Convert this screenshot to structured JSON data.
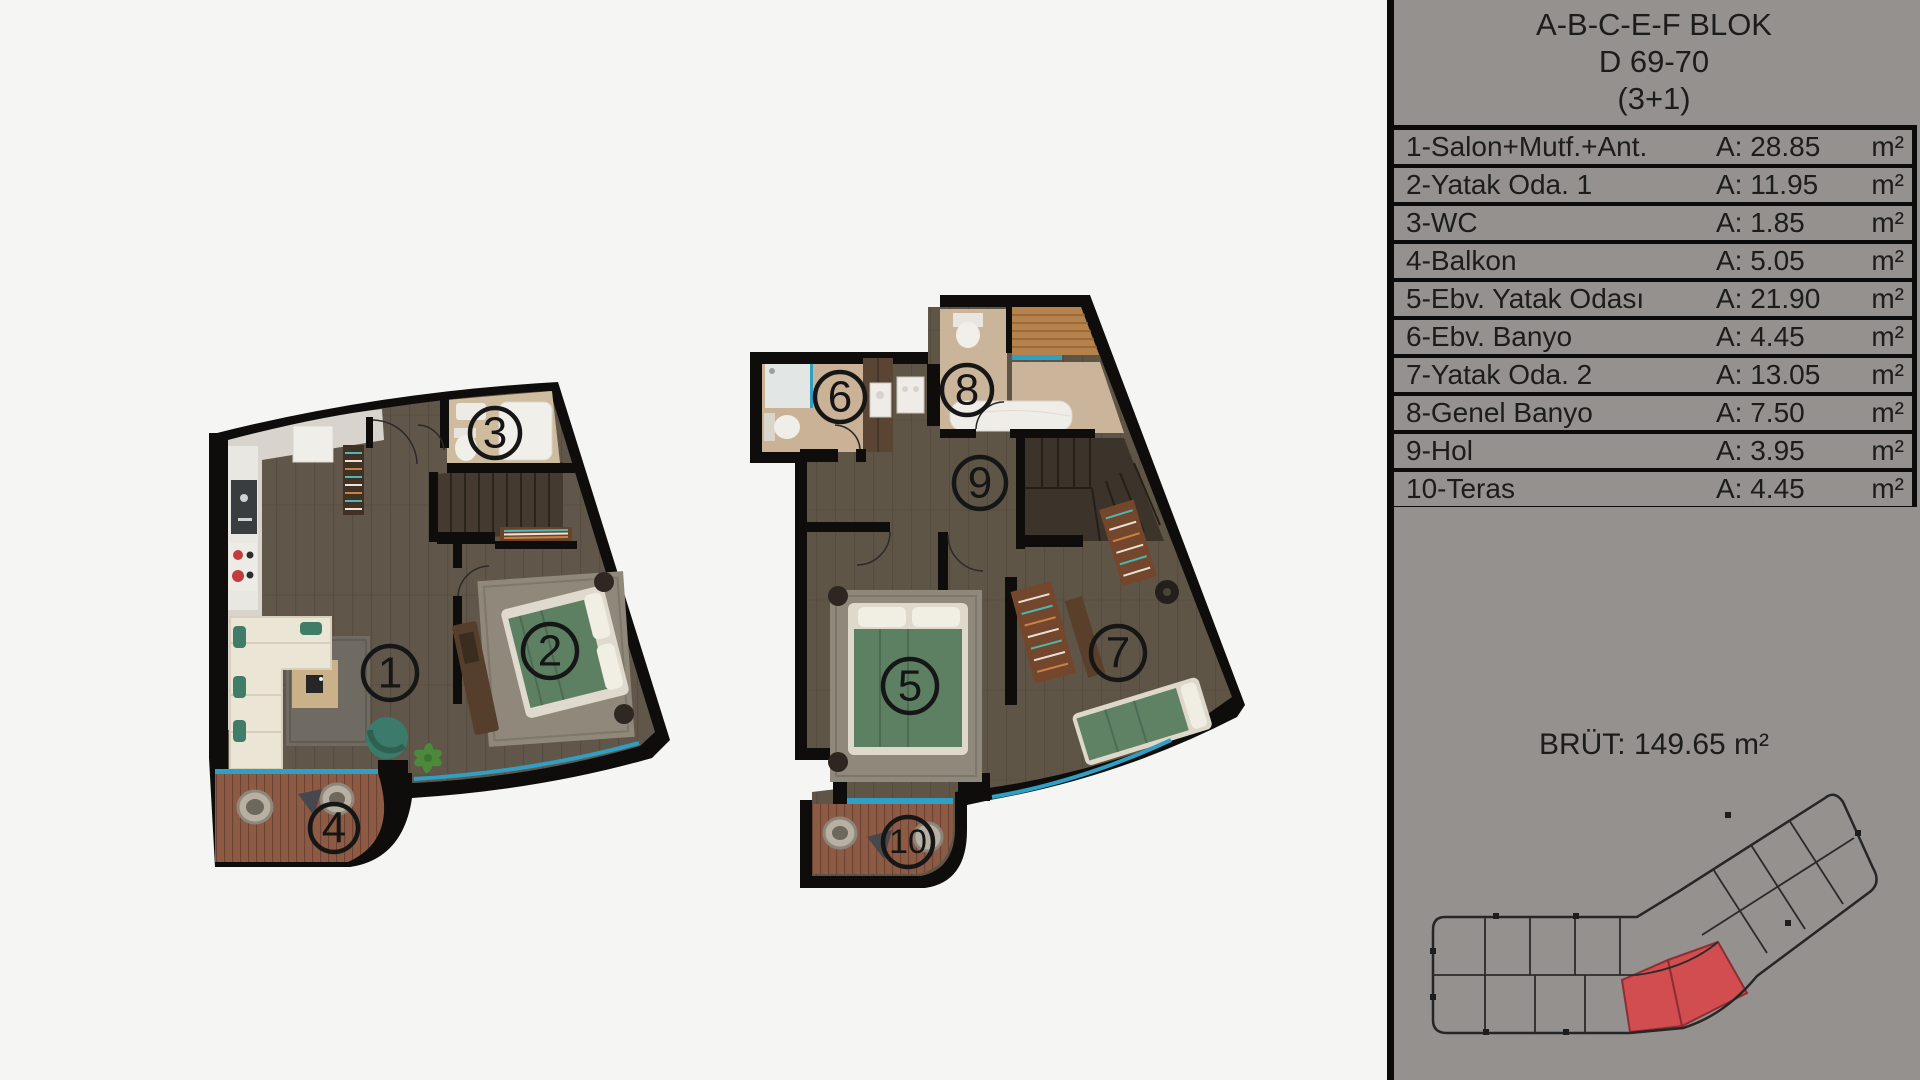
{
  "panel": {
    "header": {
      "line1": "A-B-C-E-F BLOK",
      "line2": "D 69-70",
      "line3": "(3+1)"
    },
    "rows": [
      {
        "label": "1-Salon+Mutf.+Ant.",
        "a": "A: 28.85",
        "unit": "m²"
      },
      {
        "label": "2-Yatak Oda. 1",
        "a": "A: 11.95",
        "unit": "m²"
      },
      {
        "label": "3-WC",
        "a": "A: 1.85",
        "unit": "m²"
      },
      {
        "label": "4-Balkon",
        "a": "A: 5.05",
        "unit": "m²"
      },
      {
        "label": "5-Ebv. Yatak Odası",
        "a": "A: 21.90",
        "unit": "m²"
      },
      {
        "label": "6-Ebv. Banyo",
        "a": "A: 4.45",
        "unit": "m²"
      },
      {
        "label": "7-Yatak Oda. 2",
        "a": "A: 13.05",
        "unit": "m²"
      },
      {
        "label": "8-Genel Banyo",
        "a": "A: 7.50",
        "unit": "m²"
      },
      {
        "label": "9-Hol",
        "a": "A: 3.95",
        "unit": "m²"
      },
      {
        "label": "10-Teras",
        "a": "A: 4.45",
        "unit": "m²"
      }
    ],
    "brut": "BRÜT: 149.65 m²"
  },
  "plans": {
    "lower": {
      "rooms": [
        {
          "number": "1"
        },
        {
          "number": "2"
        },
        {
          "number": "3"
        },
        {
          "number": "4"
        }
      ]
    },
    "upper": {
      "rooms": [
        {
          "number": "5"
        },
        {
          "number": "6"
        },
        {
          "number": "7"
        },
        {
          "number": "8"
        },
        {
          "number": "9"
        },
        {
          "number": "10"
        }
      ]
    }
  },
  "colors": {
    "panel_gray": "#94918f",
    "window_cyan": "#2f9fc4",
    "highlight_red": "#d14d50",
    "wall_black": "#0e0d0b"
  }
}
